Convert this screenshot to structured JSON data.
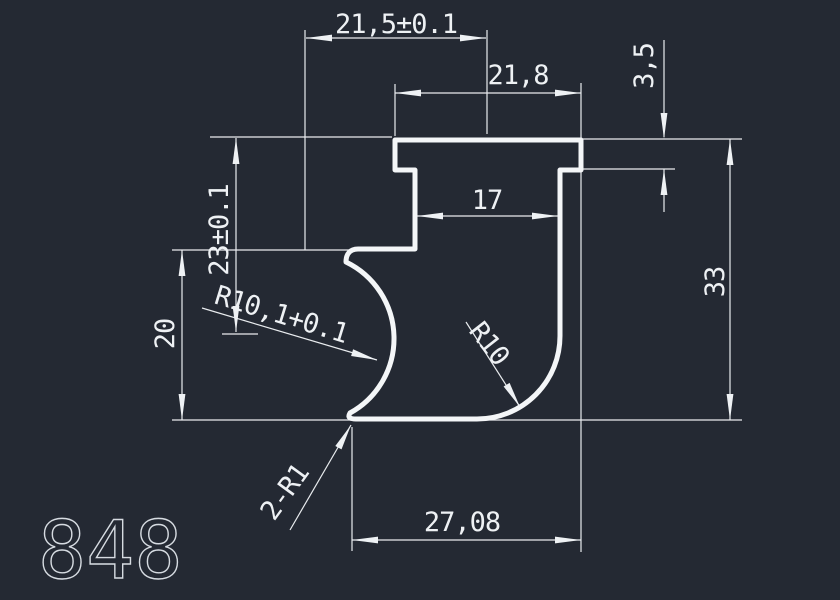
{
  "app": {
    "background": "#242933",
    "thin_line_color": "#e9ecef",
    "profile_line_color": "#f4f6f8",
    "text_color": "#eef1f4"
  },
  "drawing_number": "848",
  "dims": {
    "top_width": "21,5±0.1",
    "flange_width": "21,8",
    "flange_thickness": "3,5",
    "left_height": "23±0.1",
    "slot_width": "17",
    "lower_height": "20",
    "pocket_radius": "R10,1+0.1",
    "fillet_radius": "R10",
    "overall_height": "33",
    "corner_radii": "2-R1",
    "base_width": "27,08"
  }
}
